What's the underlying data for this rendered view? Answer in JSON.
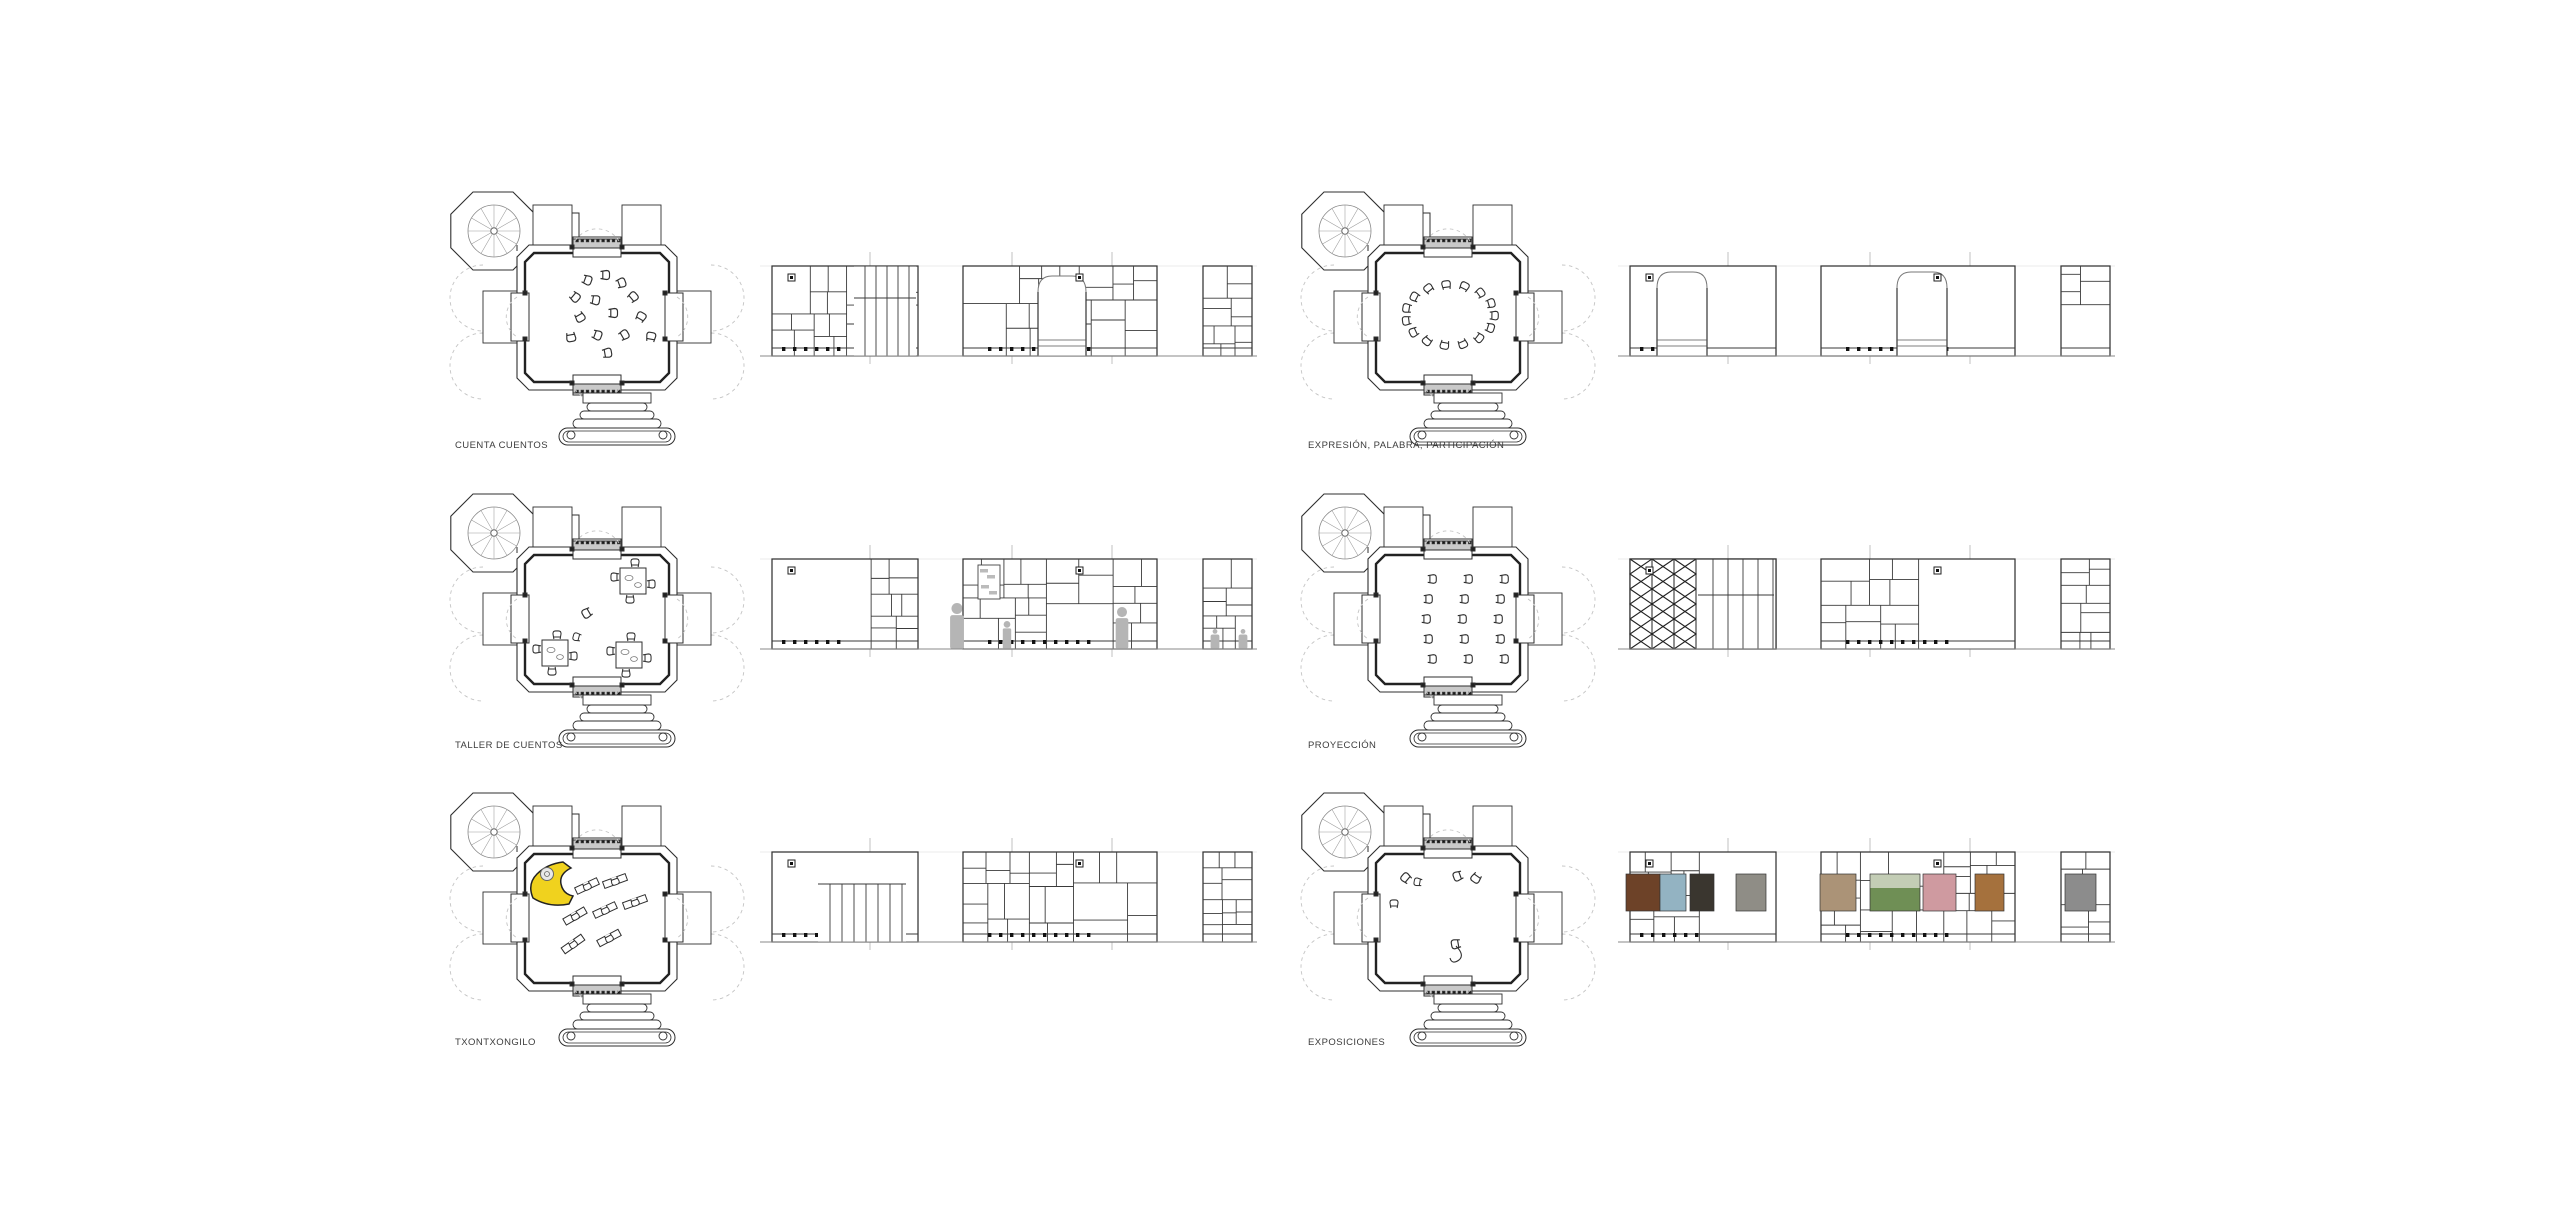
{
  "sheet": {
    "title": "Programa de usos - plantas y alzados interiores",
    "background": "#ffffff"
  },
  "units": [
    {
      "label": "CUENTA CUENTOS",
      "plan_type": "scattered-chairs",
      "elevation_type": "grid-arch"
    },
    {
      "label": "EXPRESIÓN, PALABRA, PARTICIPACIÓN",
      "plan_type": "circle-of-chairs",
      "elevation_type": "grid-two-arches"
    },
    {
      "label": "TALLER DE CUENTOS",
      "plan_type": "corner-tables",
      "elevation_type": "grid-people"
    },
    {
      "label": "PROYECCIÓN",
      "plan_type": "arc-rows",
      "elevation_type": "grid-zigzag"
    },
    {
      "label": "TXONTXONGILO",
      "plan_type": "puppet-theatre",
      "elevation_type": "grid-slats"
    },
    {
      "label": "EXPOSICIONES",
      "plan_type": "scattered-few",
      "elevation_type": "grid-photos"
    }
  ],
  "colors": {
    "ink": "#2f2f2f",
    "panel_line": "#3a3a3a",
    "grid_line": "#c0c0c0",
    "ground_line": "#8a8a8a",
    "threshold_gray": "#c9c9c9",
    "dashed_gray": "#c4c4c4",
    "figure_gray": "#b5b5b5",
    "accent_yellow": "#f0d21e",
    "photo_colors": [
      "#6d4228",
      "#93b3c2",
      "#3a362f",
      "#8f8d86",
      "#ab9377",
      "#c3cdb5",
      "#6f8f55",
      "#cf9aa0",
      "#a5713d",
      "#8c8c8c"
    ]
  }
}
